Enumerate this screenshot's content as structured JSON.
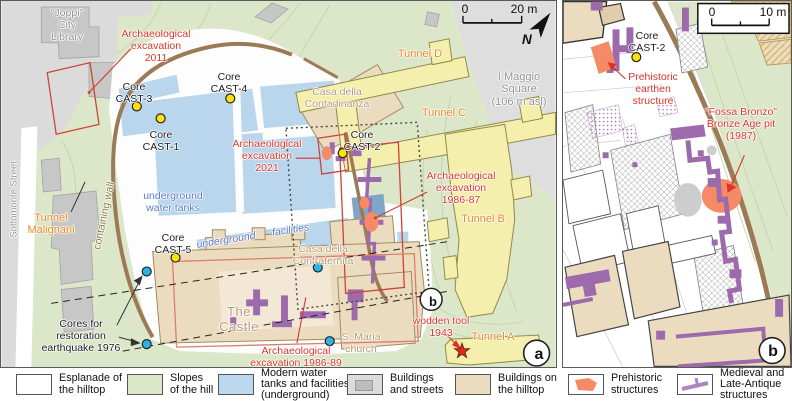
{
  "panel_a": {
    "badge": "a",
    "inset_badge": "b",
    "north_label": "N",
    "scalebar": {
      "start": "0",
      "end": "20 m"
    },
    "labels": {
      "joppi_library": "“Joppi”\nCity\nLibrary",
      "sottomonte_street": "Sottomonte Street",
      "excavation_2011": "Archaeological\nexcavation\n2011",
      "core_cast3": "Core\nCAST-3",
      "core_cast4": "Core\nCAST-4",
      "core_cast1": "Core\nCAST-1",
      "core_cast5": "Core\nCAST-5",
      "core_cast2": "Core\nCAST-2",
      "tunnel_malignani": "Tunnel\nMalignani",
      "containing_wall": "containing wall",
      "underground_water_tanks": "underground\nwater tanks",
      "underground_facilities": "underground facilities",
      "excavation_2021": "Archaeological\nexcavation\n2021",
      "excavation_1986_87": "Archaeological\nexcavation\n1986-87",
      "excavation_1986_89": "Archaeological\nexcavation 1986-89",
      "casa_contadinanza": "Casa della\nContadinanza",
      "casa_confraternita": "Casa della\nConfraternita",
      "the_castle": "The\nCastle",
      "maggio_square": "I Maggio\nSquare\n(106 m asl)",
      "cores_restoration": "Cores for\nrestoration\nearthquake 1976",
      "s_maria_church": "S. Maria\nchurch",
      "wooden_tool": "wodden tool\n1943",
      "tunnel_a": "Tunnel A",
      "tunnel_b": "Tunnel B",
      "tunnel_c": "Tunnel C",
      "tunnel_d": "Tunnel D"
    }
  },
  "panel_b": {
    "badge": "b",
    "scalebar": {
      "start": "0",
      "end": "10 m"
    },
    "labels": {
      "core_cast2": "Core\nCAST-2",
      "prehistoric_earthen": "Prehistoric\nearthen\nstructure",
      "fossa_bronzo": "“Fossa Bronzo”\nBronze Age pit\n(1987)"
    }
  },
  "legend": {
    "items": [
      {
        "key": "esplanade",
        "label": "Esplanade of\nthe hilltop"
      },
      {
        "key": "slopes",
        "label": "Slopes\nof the hill"
      },
      {
        "key": "water",
        "label": "Modern water\ntanks and facilities\n(underground)"
      },
      {
        "key": "buildings_streets",
        "label": "Buildings\nand streets"
      },
      {
        "key": "buildings_hilltop",
        "label": "Buildings on\nthe hilltop"
      },
      {
        "key": "prehistoric",
        "label": "Prehistoric\nstructures"
      },
      {
        "key": "medieval",
        "label": "Medieval and\nLate-Antique\nstructures"
      }
    ]
  },
  "colors": {
    "annotation_red": "#d8362b",
    "tunnel_orange_text": "#e8871e",
    "building_tan_text": "#b49a72",
    "water_blue_text": "#5b7cc0",
    "gray_text": "#8e9494",
    "containing_wall_text": "#8b7b42",
    "slopes_green": "#dce7ca",
    "tunnel_yellow": "#f5efae",
    "water_blue": "#b9d6ec",
    "buildings_tan": "#ecdcbf",
    "streets_gray": "#dcdcdc",
    "prehistoric_orange": "#f58b66",
    "medieval_purple": "#9d6aac",
    "wall_brown": "#9c7a55",
    "core_dot_yellow": "#ffe20a",
    "restoration_dot_cyan": "#2cb3e8"
  }
}
